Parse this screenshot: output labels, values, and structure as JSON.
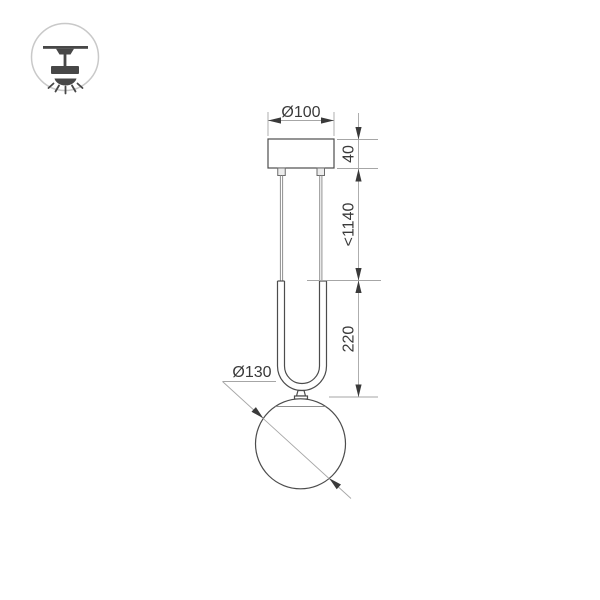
{
  "colors": {
    "bg": "#ffffff",
    "object-line": "#4c4c4c",
    "object-light": "#8f8f8f",
    "dim-line": "#a6a6a6",
    "dim-ink": "#3a3a3a",
    "badge-ring": "#c9c9c9",
    "badge-ink": "#474747",
    "connector-fill": "#ededed"
  },
  "badge": {
    "icon": "ceiling-pendant-icon"
  },
  "drawing": {
    "labels": {
      "canopy_diameter": "Ø100",
      "canopy_height": "40",
      "suspension_max_length": "<1140",
      "frame_height": "220",
      "sphere_diameter": "Ø130"
    }
  }
}
